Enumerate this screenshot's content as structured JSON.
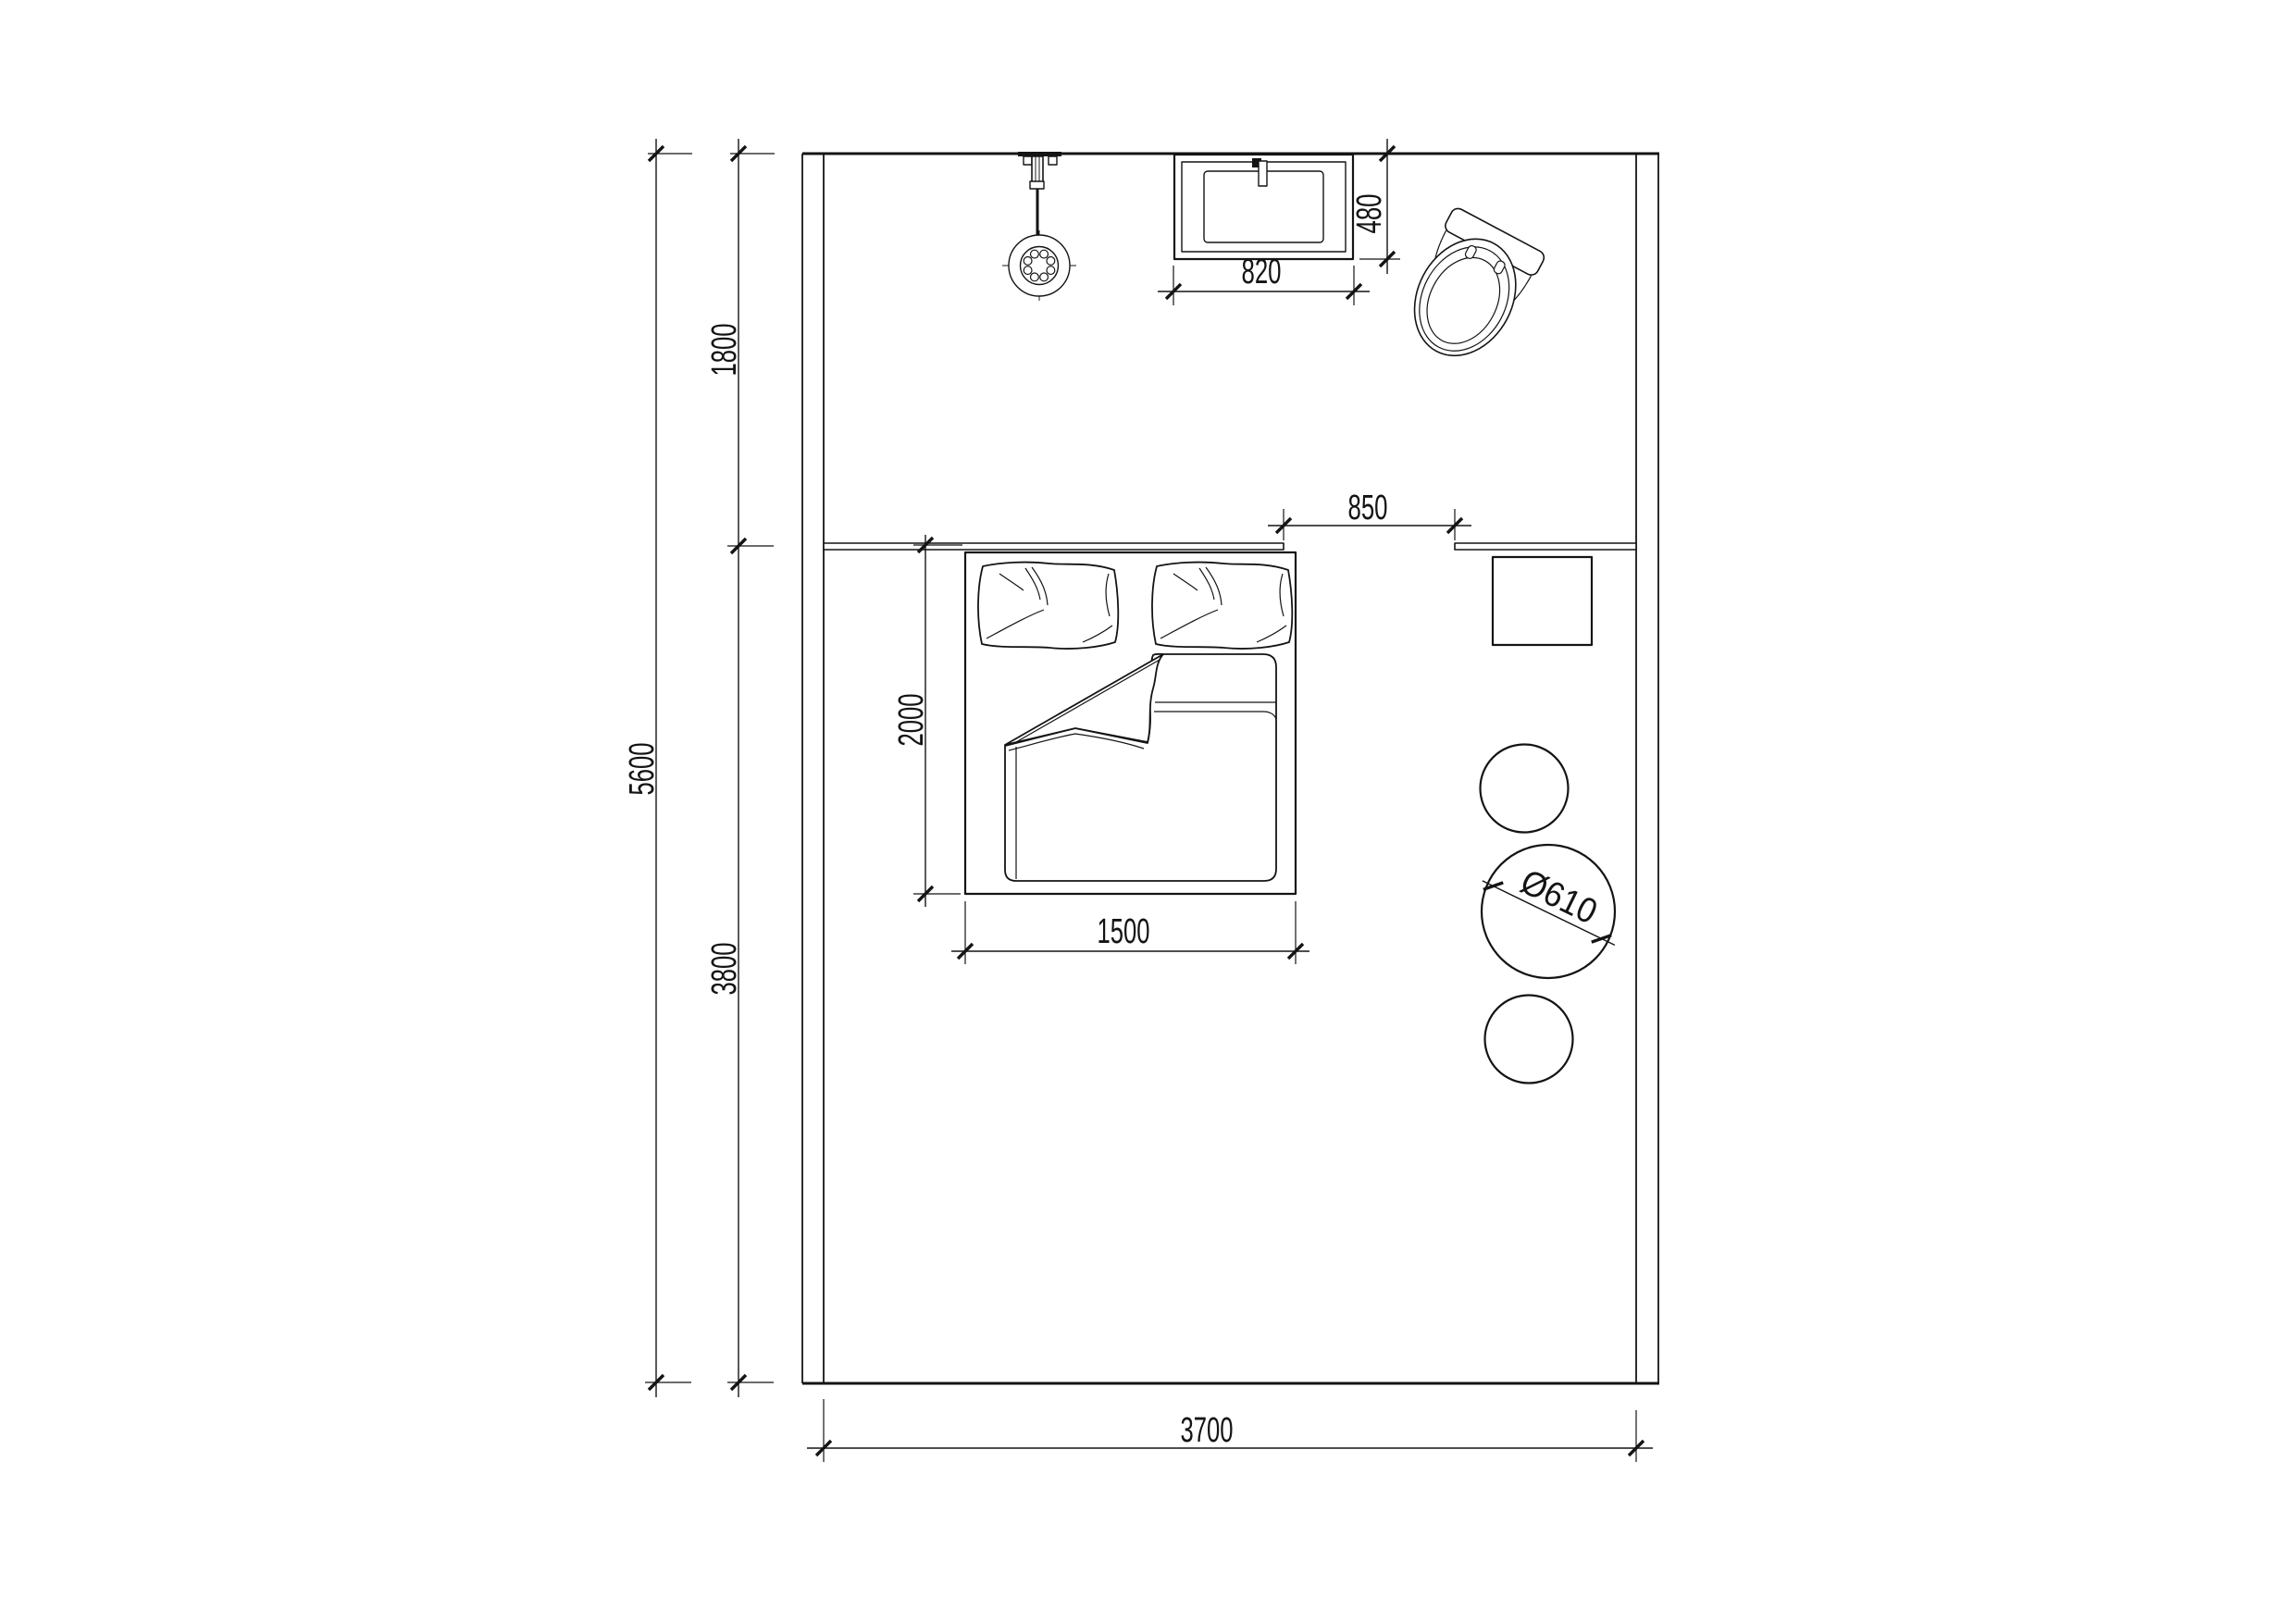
{
  "colors": {
    "ink": "#141414",
    "paper": "#ffffff"
  },
  "plan": {
    "type": "bedroom-with-bath-floor-plan",
    "dims": {
      "room_height_total": "5600",
      "bath_zone_depth": "1800",
      "bed_zone_depth": "3800",
      "vanity_width": "820",
      "vanity_depth": "480",
      "opening_width": "850",
      "bed_length": "2000",
      "bed_width": "1500",
      "table_diameter": "Ø610",
      "room_width": "3700"
    },
    "symbols": [
      "hand-shower",
      "vanity-basin",
      "faucet",
      "toilet",
      "headboard-shelf",
      "double-bed",
      "pillows",
      "duvet",
      "nightstand-square",
      "round-stool",
      "round-table"
    ]
  }
}
